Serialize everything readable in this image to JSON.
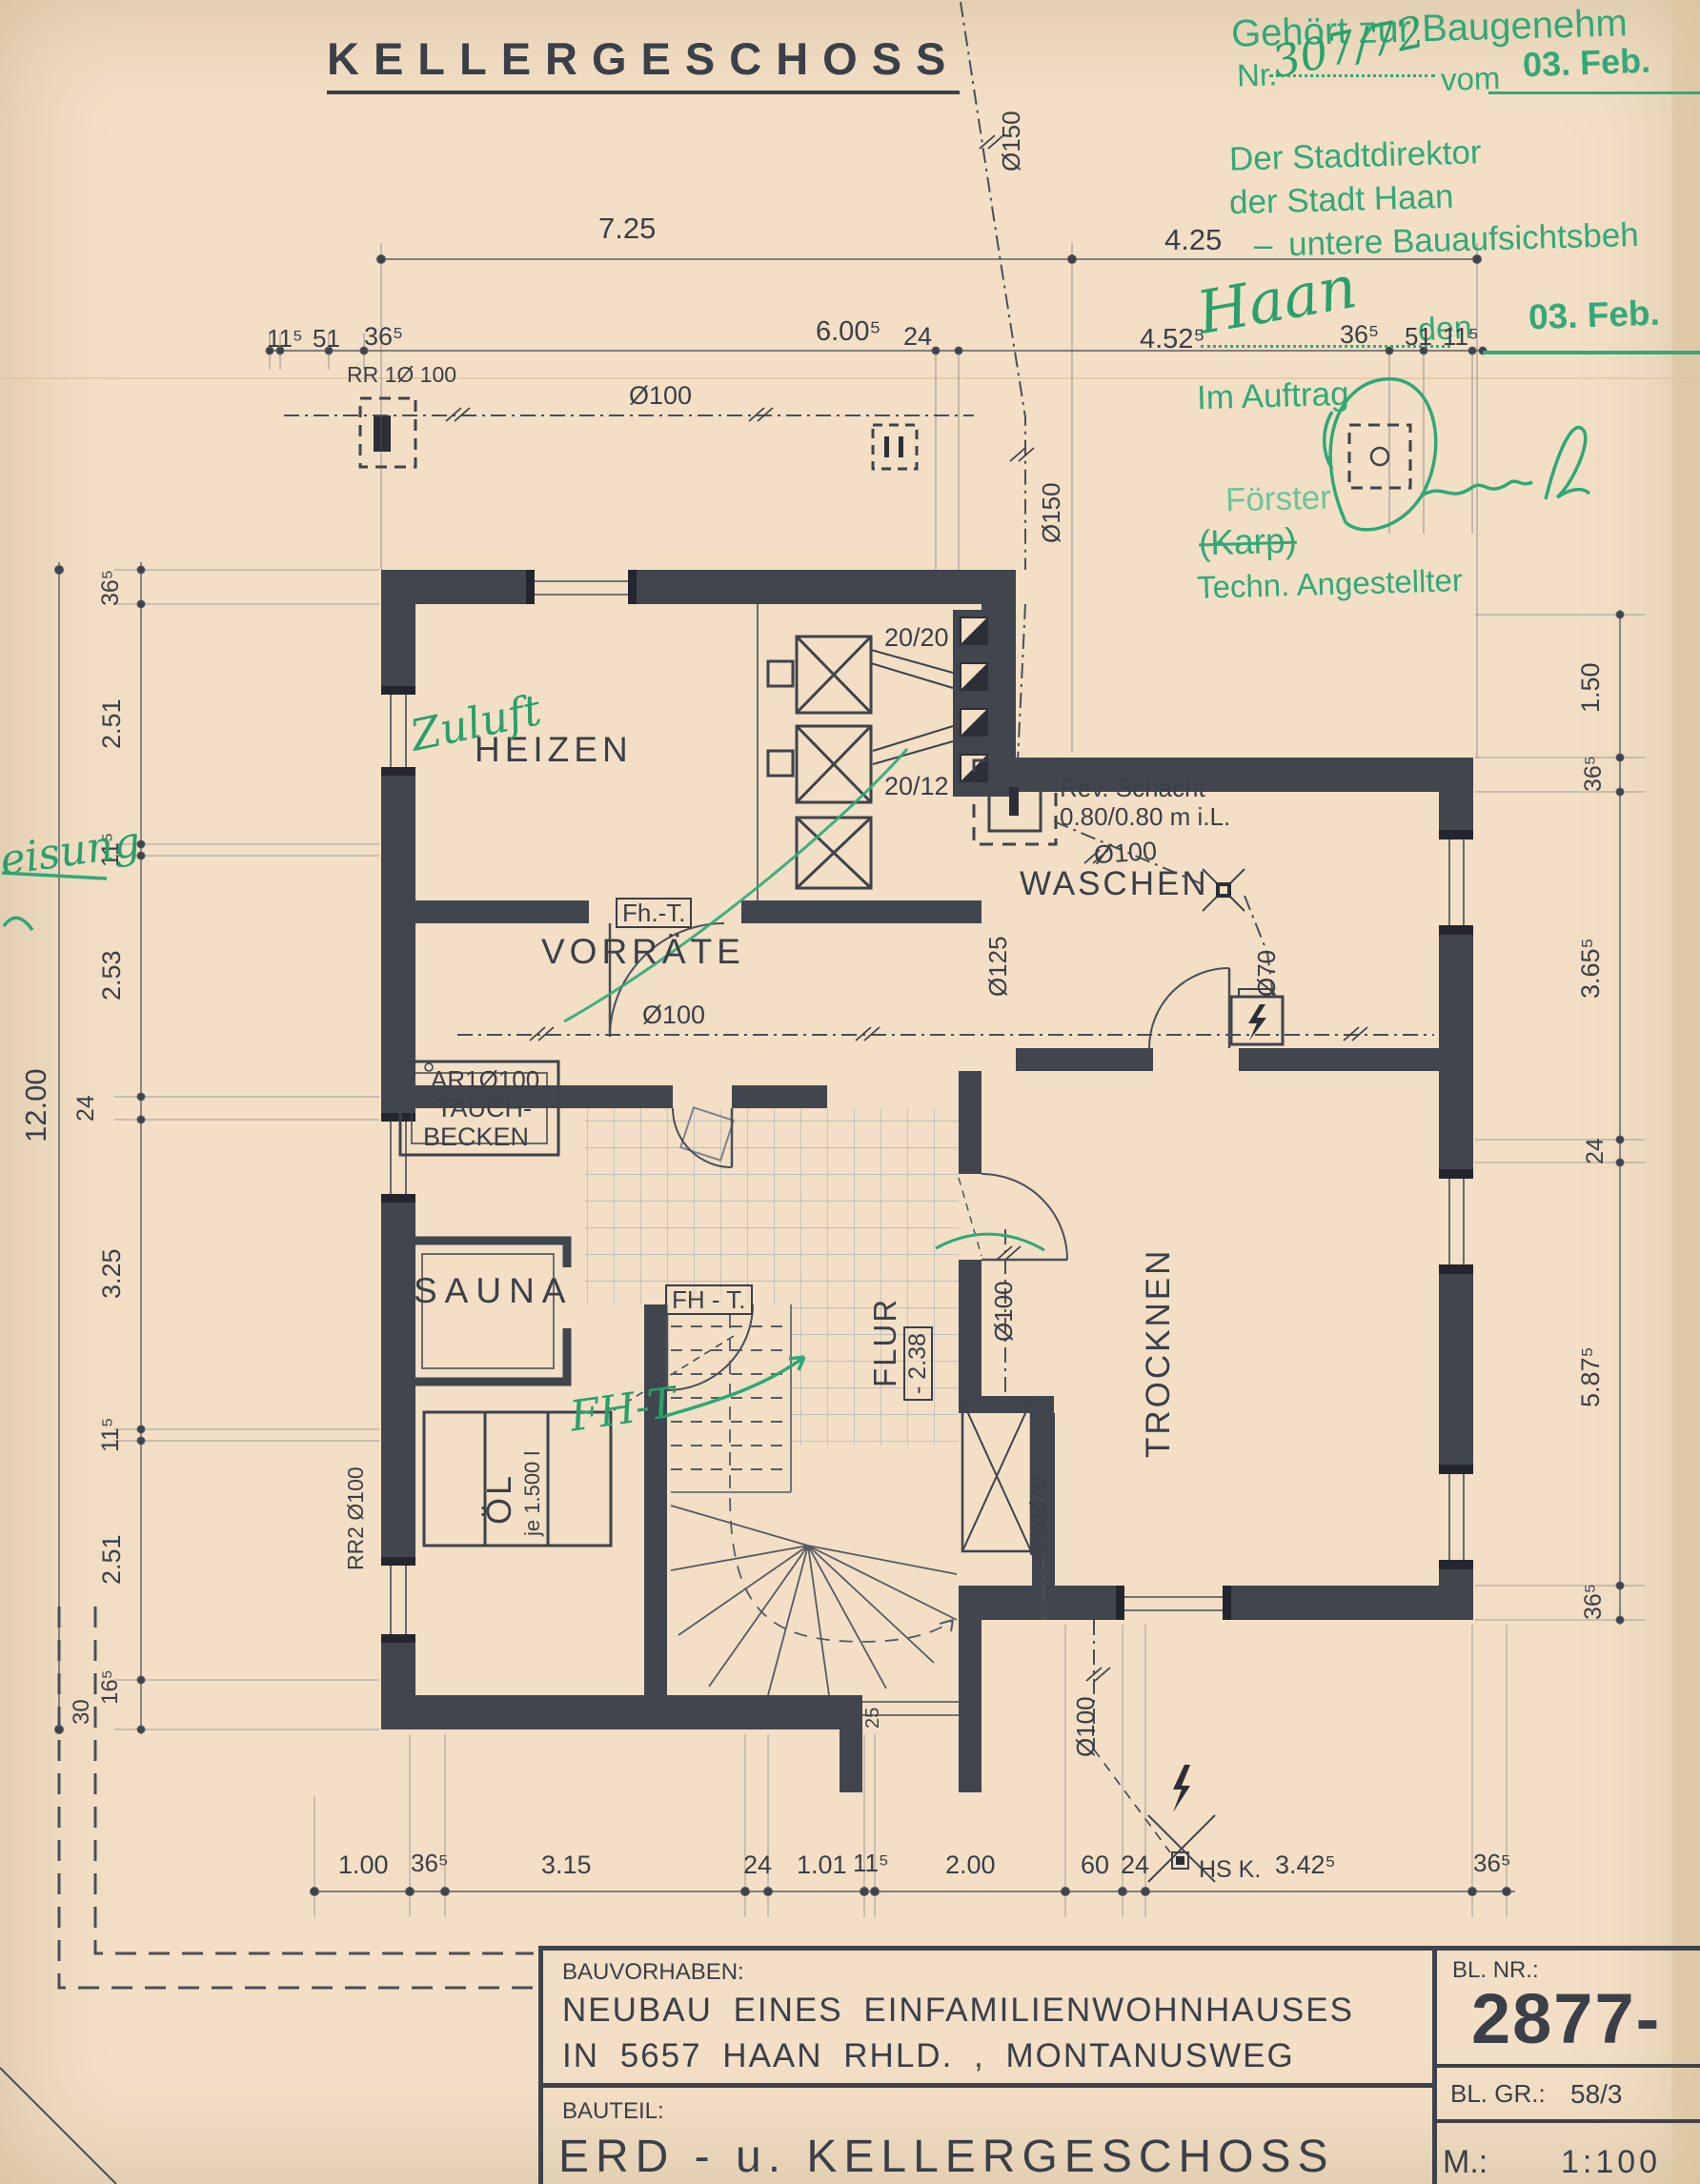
{
  "sheet": {
    "title": "KELLERGESCHOSS"
  },
  "stamp": {
    "line1": "Gehört zur Baugenehm",
    "nr_label": "Nr.",
    "nr_value": "307/72",
    "vom": "vom",
    "date1": "03. Feb.",
    "authority1": "Der Stadtdirektor",
    "authority2": "der Stadt Haan",
    "dash": "–",
    "authority3": "untere Bauaufsichtsbeh",
    "city_script": "Haan",
    "den": "den",
    "date2": "03. Feb.",
    "im_auftrag": "Im Auftrag",
    "name": "Förster",
    "name_struck": "(Karp)",
    "role": "Techn. Angestellter"
  },
  "rooms": {
    "heizen": "HEIZEN",
    "vorraete": "VORRÄTE",
    "waschen": "WASCHEN",
    "sauna": "SAUNA",
    "trocknen": "TROCKNEN",
    "flur": "FLUR",
    "flur_level": "- 2.38",
    "tauchbecken1": "TAUCH-",
    "tauchbecken2": "BECKEN",
    "oel": "ÖL",
    "oel_sub": "je 1.500 l"
  },
  "annotations": {
    "zuluft": "Zuluft",
    "fht_green": "FH-T",
    "door1": "Fh.-T.",
    "door2": "FH - T.",
    "rev1": "Rev. Schacht",
    "rev2": "0.80/0.80 m i.L.",
    "ar1": "AR1Ø100",
    "ar2": "AR2Ø70",
    "rr1": "RR 1Ø 100",
    "rr2": "RR2 Ø100",
    "d100": "Ø100",
    "d125": "Ø125",
    "d150": "Ø150",
    "d70": "Ø70",
    "f2020": "20/20",
    "f2012": "20/12",
    "hsk": "HS K.",
    "eisung": "eisung",
    "s25": "25"
  },
  "dims": {
    "top1": [
      "7.25",
      "4.25"
    ],
    "top2": [
      "11⁵",
      "51",
      "36⁵",
      "6.00⁵",
      "24",
      "4.52⁵",
      "36⁵",
      "51",
      "11⁵"
    ],
    "left_total": "12.00",
    "left_chain": [
      "36⁵",
      "2.51",
      "11⁵",
      "2.53",
      "24",
      "3.25",
      "11⁵",
      "2.51",
      "16⁵",
      "30"
    ],
    "right_chain": [
      "1.50",
      "36⁵",
      "3.65⁵",
      "24",
      "5.87⁵",
      "36⁵"
    ],
    "bottom_chain": [
      "1.00",
      "36⁵",
      "3.15",
      "24",
      "1.01",
      "11⁵",
      "2.00",
      "60",
      "24",
      "3.42⁵",
      "36⁵"
    ]
  },
  "titleblock": {
    "bauvorhaben_label": "BAUVORHABEN:",
    "line1": "NEUBAU EINES EINFAMILIENWOHNHAUSES",
    "line2": "IN 5657 HAAN RHLD. , MONTANUSWEG",
    "bauteil_label": "BAUTEIL:",
    "bauteil": "ERD - u. KELLERGESCHOSS",
    "blnr_label": "BL. NR.:",
    "blnr": "2877-",
    "blgr_label": "BL. GR.:",
    "blgr": "58/3",
    "m_label": "M.:",
    "m": "1:100"
  }
}
